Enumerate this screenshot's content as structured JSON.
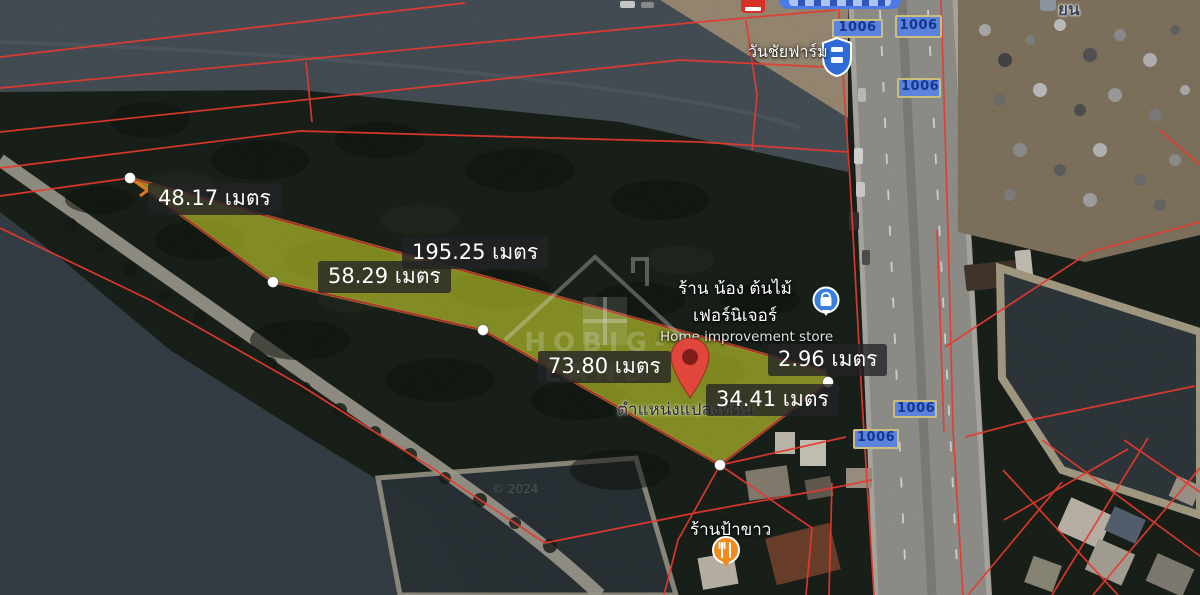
{
  "measurements": [
    {
      "text": "48.17 เมตร"
    },
    {
      "text": "195.25 เมตร"
    },
    {
      "text": "58.29 เมตร"
    },
    {
      "text": "73.80 เมตร"
    },
    {
      "text": "2.96 เมตร"
    },
    {
      "text": "34.41 เมตร"
    }
  ],
  "pin": {
    "label": "ตำแหน่งแปลงที่ดิน"
  },
  "pois": {
    "farm": "วันชัยฟาร์ม",
    "store_line1": "ร้าน น้อง ต้นไม้",
    "store_line2": "เฟอร์นิเจอร์",
    "store_subtitle": "Home improvement store",
    "restaurant": "ร้านป้าขาว",
    "partial_top_right": "ยน"
  },
  "roads": {
    "route_label": "1006"
  },
  "watermark": {
    "brand": "HOBIG-LAND",
    "attribution": "© 2024"
  },
  "colors": {
    "label_bg": "rgba(35,35,38,0.78)",
    "parcel_fill": "#c9d32c",
    "parcel_stroke": "#dde43e",
    "boundary_red": "#e8392e",
    "boundary_dark_red": "#a8332a",
    "badge_bg": "#5b82dd",
    "badge_border": "#cabe7e",
    "badge_text": "#14368f",
    "pin_red": "#e2453c",
    "shield_blue": "#2e6bd6",
    "store_icon_blue": "#3a7ede",
    "restaurant_icon_orange": "#ef8b1f"
  }
}
